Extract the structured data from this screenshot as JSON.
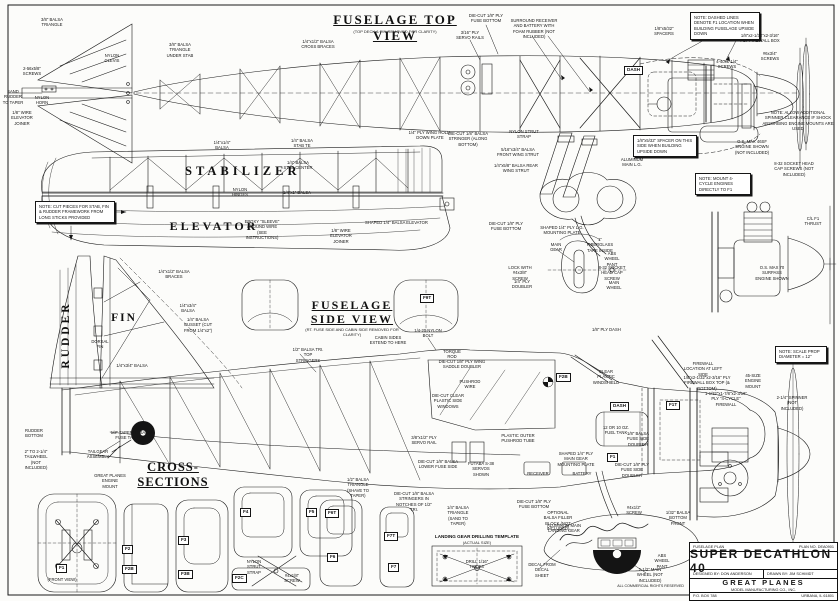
{
  "views": {
    "top": {
      "title": "FUSELAGE TOP VIEW",
      "sub": "(TOP DECK & FIN REMOVED FOR CLARITY)"
    },
    "stab": "STABILIZER",
    "elev": "ELEVATOR",
    "fin": "FIN",
    "rudder": "RUDDER",
    "side": {
      "l1": "FUSELAGE",
      "l2": "SIDE VIEW",
      "sub": "(RT. FUSE SIDE AND CABIN SIDE REMOVED FOR CLARITY)"
    },
    "cross": "CROSS-SECTIONS",
    "lgt": {
      "title": "LANDING GEAR DRILLING TEMPLATE",
      "sub": "(ACTUAL SIZE)"
    }
  },
  "notes": [
    "NOTE: DASHED LINES DENOTE F1 LOCATION WHEN BUILDING FUSELAGE UPSIDE DOWN",
    "NOTE: CUT PIECES FOR STAB, FIN & RUDDER FRAMEWORK FROM LONG STICKS PROVIDED",
    "1/8\"x5/32\" SPACER ON THIS SIDE WHEN BUILDING UPSIDE DOWN",
    "NOTE: MOUNT 4-CYCLE ENGINES DIRECTLY TO F1",
    "NOTE: SCALE PROP DIAMETER = 12\"",
    "NOTE: ALLOW ADDITIONAL SPINNER CLEARANCE IF SHOCK ABSORBING ENGINE MOUNTS ARE USED"
  ],
  "labels": [
    "3/8\" BALSA TRIANGLE",
    "2-56x5/8\" SCREWS",
    "NYLON CLEVIS",
    "SAND RUDDER TO TAPER",
    "NYLON HORN",
    "1/8\" WIRE ELEVATOR JOINER",
    "3/8\" BALSA TRIANGLE UNDER STAB",
    "1/4\"x1/2\" BALSA CROSS BRACES",
    "DIE-CUT 1/8\" PLY FUSE BOTTOM",
    "3/16\" PLY SERVO RAILS",
    "SURROUND RECEIVER AND BATTERY WITH FOAM RUBBER (NOT INCLUDED)",
    "1/8\"x5/32\" SPACERS",
    "1/8\"x2-1/32\"x2-3/16\" PLY FIREWALL BOX",
    "4-40x1-1/4\" SCREWS",
    "#6x3/4\" SCREWS",
    "1/4\"x1/4\" BALSA",
    "1/4\" BALSA STAB TE",
    "1/4\" BALSA STAB CENTER",
    "NYLON HINGES",
    "1/4\"x1\" BALSA",
    "EPOXY \"SLEEVE\" AROUND WIRE (SEE INSTRUCTIONS)",
    "SHAPED 1/4\" BALSA ELEVATOR",
    "1/8\" WIRE ELEVATOR JOINER",
    "1/4\" PLY WING HOLD-DOWN PLATE",
    "DIE-CUT 1/8\" BALSA STRINGER (ALONG BOTTOM)",
    "NYLON STRUT STRAP",
    "5/16\"x3/4\" BALSA FRONT WING STRUT",
    "1/4\"x5/8\" BALSA REAR WING STRUT",
    "ALUMINUM MAIN L.G.",
    "1/4\"x1/2\" BALSA BRACES",
    "1/4\"x3/4\" BALSA",
    "1/4\" BALSA GUSSET (CUT FROM 1/4\"x2\")",
    "DORSAL FIN",
    "1/4\"x3/4\" BALSA",
    "O.S. MAX 46SF ENGINE SHOWN (NOT INCLUDED)",
    "8-32 SOCKET HEAD CAP SCREWS (NOT INCLUDED)",
    "O.S. MAX 70 SURPASS ENGINE SHOWN",
    "DIE-CUT 1/8\" PLY FUSE BOTTOM",
    "SHAPED 1/4\" PLY L.G. MOUNTING PLATE",
    "MAIN GEAR",
    "1\" FIBERGLASS TAPE INSIDE",
    "ABS WHEEL PANT",
    "LOCK WITH #4x3/8\" SCREW",
    "8-32 SOCKET HEAD CAP SCREW",
    "MAIN WHEEL",
    "1/4\" PLY DOUBLER",
    "1/2\" BALSA TRI. TOP STRINGERS",
    "CABIN SIDES EXTEND TO HERE",
    "1/4-20 NYLON BOLT",
    "TORQUE ROD",
    "DIE-CUT 1/8\" PLY WING SADDLE DOUBLER",
    "PUSHROD WIRE",
    "DIE-CUT CLEAR PLASTIC SIDE WINDOWS",
    "CLEAR PLASTIC WINDSHIELD",
    "12 OR 10 OZ. FUEL TANK",
    "1/8\" BALSA FUSE SIDE DOUBLER",
    "3/8\"x1/2\" PLY SERVO RAIL",
    "PLASTIC OUTER PUSHROD TUBE",
    "DIE-CUT 1/8\" BALSA LOWER FUSE SIDE",
    "FUTABA S-38 SERVOS SHOWN",
    "RECEIVER",
    "BATTERY",
    "SHAPED 1/4\" PLY MAIN GEAR MOUNTING PLATE",
    "DIE-CUT 1/8\" PLY FUSE SIDE DOUBLER",
    "FIREWALL LOCATION AT LEFT SIDE",
    "1/8\"x2-1/32\"x2-3/16\" PLY FIREWALL BOX TOP (& BOTTOM)",
    "1-1/32\"x1-7/8\"x2-3/16\" PLY \"4-CYCLE\" FIREWALL",
    "45-SIZE ENGINE MOUNT",
    "2-1/4\" SPINNER (NOT INCLUDED)",
    "1/8\" PLY DASH",
    "1/2\" TAPERED BALSA FUSE TAIL POST",
    "RUDDER BOTTOM",
    "2\" TO 2-1/4\" TAILWHEEL (NOT INCLUDED)",
    "TAILGEAR ASSEMBLY",
    "GREAT PLANES ENGINE MOUNT",
    "1/4\" BALSA TRIANGLE (SAND TO TAPER)",
    "DIE-CUT 1/8\" PLY FUSE BOTTOM",
    "OPTIONAL BALSA FILLER BLOCK (NOT INCLUDED)",
    "ALUMINUM MAIN LANDING GEAR",
    "#4x1/2\" SCREW",
    "1/32\" BALSA BOTTOM FRONT",
    "DECAL FROM DECAL SHEET",
    "ABS WHEEL PANT",
    "2-1/2\" MAIN WHEEL (NOT INCLUDED)",
    "1/2\" BALSA TRIANGLE (SHAVE TO TAPER)",
    "DIE-CUT 1/8\" BALSA STRINGERS IN NOTCHES OF 1/2\" TRI.",
    "DRILL 1/16\" HOLES",
    "NYLON STRUT STRAP",
    "#4x1/8\" SCREW",
    "C/L F1 THRUST",
    "(FRONT VIEW)"
  ],
  "formers": [
    "F1",
    "F2",
    "F2B",
    "F2C",
    "F3",
    "F3B",
    "F4",
    "F5",
    "F6",
    "F6T",
    "F7",
    "F7T",
    "F9T",
    "F1T",
    "DASH",
    "F2B",
    "F1",
    "DASH"
  ],
  "title_block": {
    "doc_type": "FUSELAGE PLAN",
    "plan_no": "PLAN NO. DEA0901",
    "title": "SUPER DECATHLON 40",
    "designed_by": "DESIGNED BY: DON ANDERSON",
    "drawn_by": "DRAWN BY: JIM SCHMIDT",
    "company": "GREAT PLANES",
    "company2": "MODEL MANUFACTURING CO., INC.",
    "po_box": "P.O. BOX 788",
    "city": "URBANA, IL 61801"
  },
  "footer": {
    "rights": "ALL COMMERCIAL RIGHTS RESERVED"
  },
  "colors": {
    "ink": "#161616",
    "paper": "#fcfcfa"
  }
}
